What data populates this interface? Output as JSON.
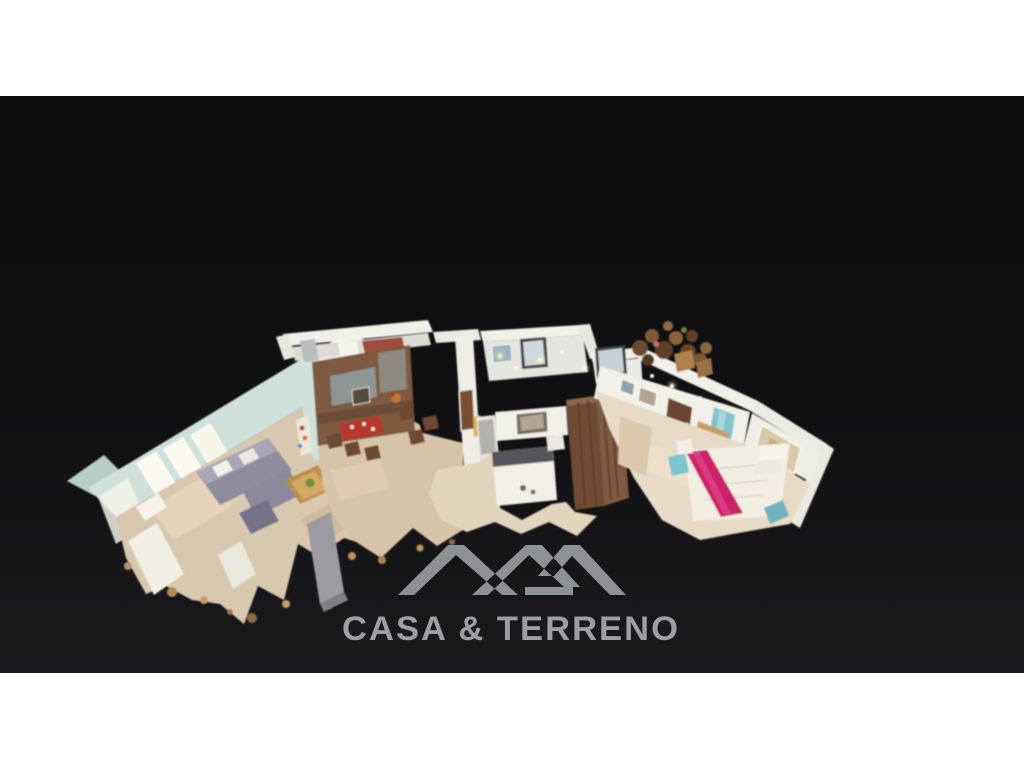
{
  "canvas": {
    "width": 1024,
    "height": 768,
    "letterbox_top_height": 96,
    "letterbox_bottom_y": 673,
    "letterbox_color": "#ffffff"
  },
  "palette": {
    "white_band": "#ffffff",
    "backdrop_top": "#0c0c0e",
    "backdrop_bottom": "#1a191c",
    "logo_mark": "#8e9194",
    "logo_text": "#9b9ea2",
    "wood_floor": "#d9c8b0",
    "wood_mid": "#d6c4a8",
    "wall_white": "#f0efe8",
    "wall_mint": "#cfe1da",
    "sofa_gray": "#8f8c9d",
    "accent_wood": "#7d5a41",
    "bed_magenta": "#c92467",
    "teal_accent": "#7fc3cd",
    "wardrobe_brown": "#6e4b33"
  },
  "watermark": {
    "brand_text": "CASA & TERRENO",
    "mark": "double-roof-monogram"
  },
  "scene": {
    "type": "3d-dollhouse-floorplan-cutaway",
    "rooms": [
      {
        "name": "living room",
        "features": "gray corner sofa, wooden coffee table, window wall, white sideboard"
      },
      {
        "name": "kitchen",
        "features": "white back wall, counter with appliances"
      },
      {
        "name": "dining area",
        "features": "rustic wood accent wall, red table setting, wooden chairs"
      },
      {
        "name": "hallway",
        "features": "white walls, two dark-framed windows, ceiling downlights"
      },
      {
        "name": "bedroom",
        "features": "white bed with dark blanket, slatted wooden wardrobe, wall picture"
      },
      {
        "name": "master bedroom",
        "features": "double bed with magenta runner, teal curtains, wooden dresser, large painting"
      },
      {
        "name": "terrace corner",
        "features": "wooden chairs and plants"
      }
    ]
  }
}
